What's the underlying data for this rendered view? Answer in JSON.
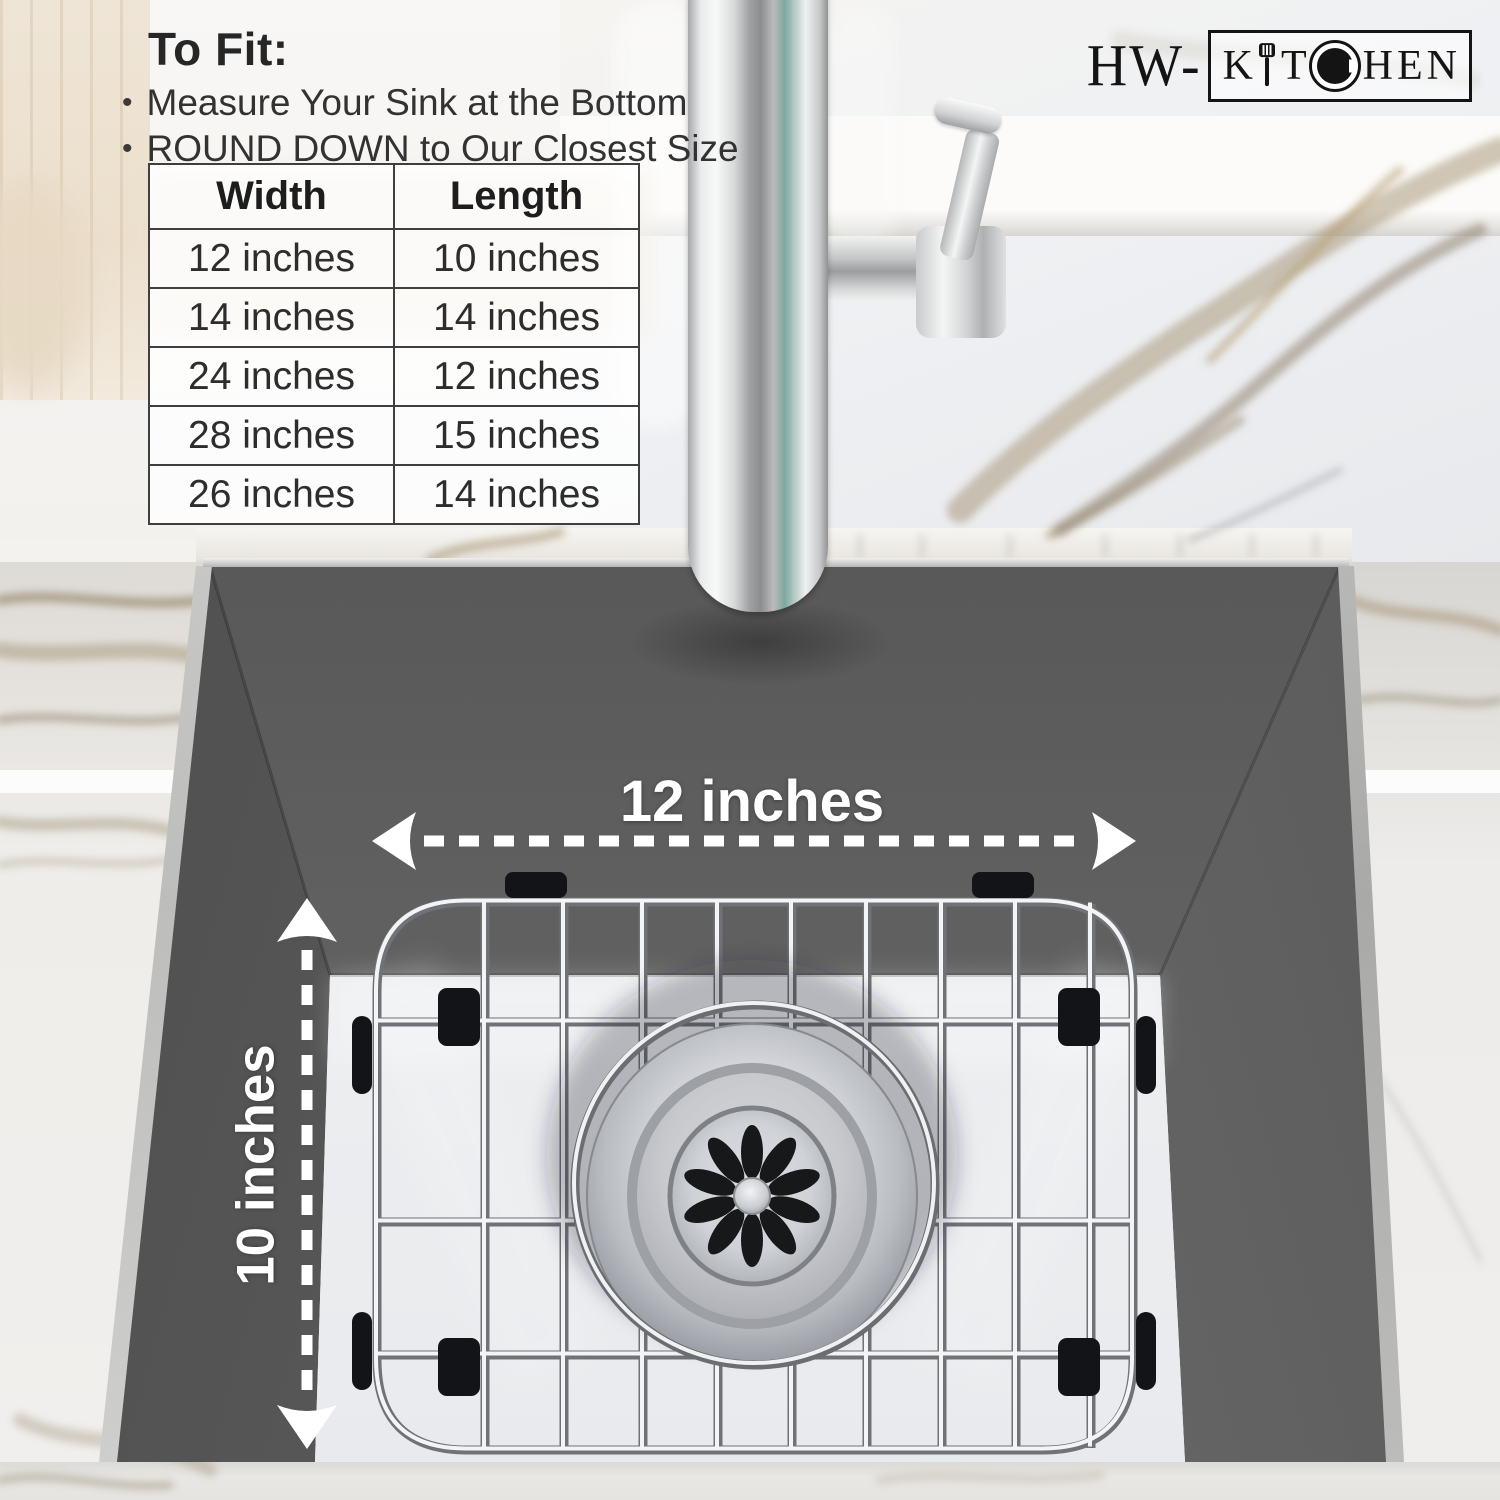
{
  "brand": {
    "logo_prefix": "HW-",
    "logo_boxed_letters": [
      "K",
      "I",
      "T",
      "C",
      "H",
      "E",
      "N"
    ]
  },
  "fit_guide": {
    "title": "To Fit:",
    "bullet_marker": "•",
    "bullets": [
      "Measure Your Sink at the Bottom",
      "ROUND DOWN to Our Closest Size"
    ]
  },
  "size_table": {
    "headers": [
      "Width",
      "Length"
    ],
    "rows": [
      [
        "12 inches",
        "10 inches"
      ],
      [
        "14 inches",
        "14 inches"
      ],
      [
        "24 inches",
        "12 inches"
      ],
      [
        "28 inches",
        "15 inches"
      ],
      [
        "26 inches",
        "14 inches"
      ]
    ]
  },
  "annotations": {
    "width_label": "12 inches",
    "depth_label": "10 inches"
  },
  "colors": {
    "sink_gray": "#5a5a5a",
    "annotation_white": "#ffffff",
    "logo_black": "#141414",
    "marble_gold": "#a4916f",
    "table_border": "#3f3f3f"
  }
}
